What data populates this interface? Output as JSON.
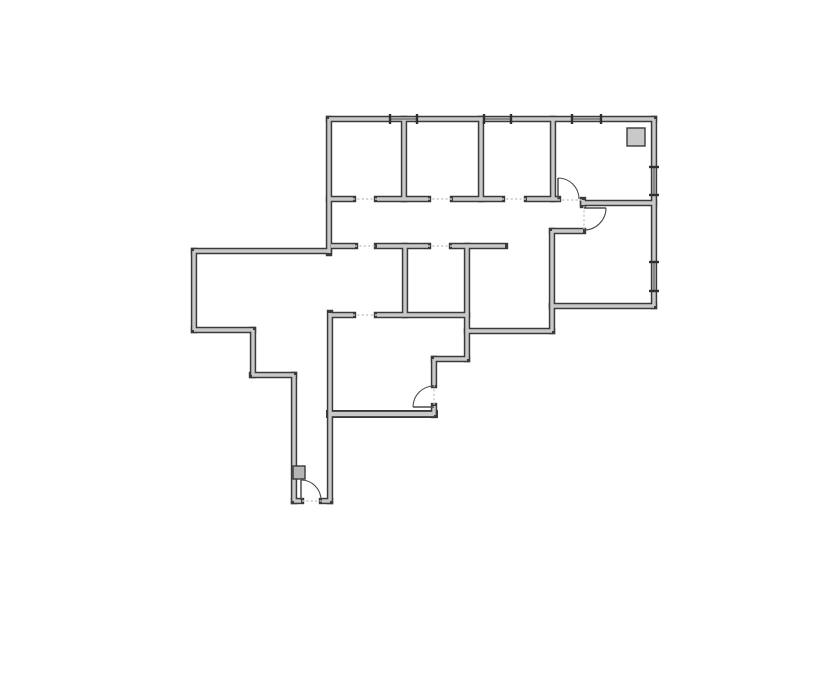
{
  "document": {
    "kind": "architectural-floor-plan",
    "background": "#ffffff",
    "canvas": {
      "width": 835,
      "height": 678
    }
  },
  "style": {
    "wall_outline_color": "#3a3a3a",
    "wall_core_color": "#c9c9c9",
    "wall_outer_width": 6.4,
    "wall_inner_width": 3.4,
    "opening_dash_color": "#c6c6c6",
    "door_line_color": "#4a4a4a",
    "window_glass_color": "#4a4a4a",
    "window_tick_color": "#2f2f2f",
    "fixture_stroke_color": "#3a3a3a"
  },
  "walls": [
    [
      329,
      119,
      654,
      119
    ],
    [
      654,
      119,
      654,
      306
    ],
    [
      654,
      306,
      552,
      306
    ],
    [
      552,
      306,
      552,
      331
    ],
    [
      552,
      331,
      467,
      331
    ],
    [
      467,
      246,
      467,
      359
    ],
    [
      467,
      359,
      434,
      359
    ],
    [
      434,
      359,
      434,
      385
    ],
    [
      434,
      406,
      434,
      415
    ],
    [
      434,
      414,
      330,
      414,
      1.25
    ],
    [
      330,
      313,
      330,
      501
    ],
    [
      330,
      501,
      322,
      501
    ],
    [
      301,
      501,
      294,
      501
    ],
    [
      294,
      501,
      294,
      375
    ],
    [
      294,
      375,
      252,
      375
    ],
    [
      253,
      375,
      253,
      330
    ],
    [
      253,
      330,
      194,
      330
    ],
    [
      194,
      330,
      194,
      251
    ],
    [
      194,
      251,
      329,
      251
    ],
    [
      329,
      253,
      329,
      119
    ],
    [
      404,
      119,
      404,
      199
    ],
    [
      481,
      119,
      481,
      199
    ],
    [
      553,
      119,
      553,
      199
    ],
    [
      329,
      199,
      353,
      199
    ],
    [
      377,
      199,
      428,
      199
    ],
    [
      453,
      199,
      502,
      199
    ],
    [
      527,
      199,
      558,
      199
    ],
    [
      583,
      200,
      583,
      205
    ],
    [
      583,
      203,
      654,
      203
    ],
    [
      552,
      231,
      583,
      231
    ],
    [
      552,
      231,
      552,
      306
    ],
    [
      331,
      246,
      355,
      246
    ],
    [
      377,
      246,
      428,
      246
    ],
    [
      452,
      246,
      505,
      246
    ],
    [
      405,
      246,
      405,
      315
    ],
    [
      331,
      315,
      353,
      315
    ],
    [
      377,
      315,
      467,
      315
    ]
  ],
  "openings": [
    [
      353,
      199,
      377,
      199
    ],
    [
      428,
      199,
      453,
      199
    ],
    [
      502,
      199,
      527,
      199
    ],
    [
      558,
      200,
      583,
      200
    ],
    [
      584,
      206,
      584,
      229
    ],
    [
      355,
      246,
      377,
      246
    ],
    [
      428,
      246,
      452,
      246
    ],
    [
      353,
      315,
      377,
      315
    ],
    [
      434,
      385,
      434,
      406
    ],
    [
      302,
      501,
      322,
      501
    ]
  ],
  "doors": [
    {
      "name": "door-top-right-room",
      "hinge": [
        558,
        199
      ],
      "tip": [
        558,
        178
      ],
      "strike": [
        579,
        199
      ],
      "r": 21
    },
    {
      "name": "door-big-right-room",
      "hinge": [
        584,
        208
      ],
      "tip": [
        606,
        208
      ],
      "strike": [
        584,
        230
      ],
      "r": 22
    },
    {
      "name": "door-bottom-middle-room",
      "hinge": [
        434,
        407
      ],
      "tip": [
        413,
        407
      ],
      "strike": [
        434,
        386
      ],
      "r": 21
    },
    {
      "name": "door-suite-entry",
      "hinge": [
        301,
        500
      ],
      "tip": [
        301,
        480
      ],
      "strike": [
        321,
        500
      ],
      "r": 20
    }
  ],
  "windows": [
    [
      390,
      119,
      417,
      119
    ],
    [
      484,
      119,
      511,
      119
    ],
    [
      572,
      119,
      601,
      119
    ],
    [
      654,
      167,
      654,
      195
    ],
    [
      654,
      262,
      654,
      291
    ]
  ],
  "fixtures": [
    {
      "name": "column-block",
      "x": 627,
      "y": 128,
      "w": 18,
      "h": 18,
      "fill": "#c9c9c9"
    },
    {
      "name": "wall-mounted-panel",
      "x": 293,
      "y": 466,
      "w": 12,
      "h": 13,
      "fill": "#b5b5b5"
    }
  ]
}
